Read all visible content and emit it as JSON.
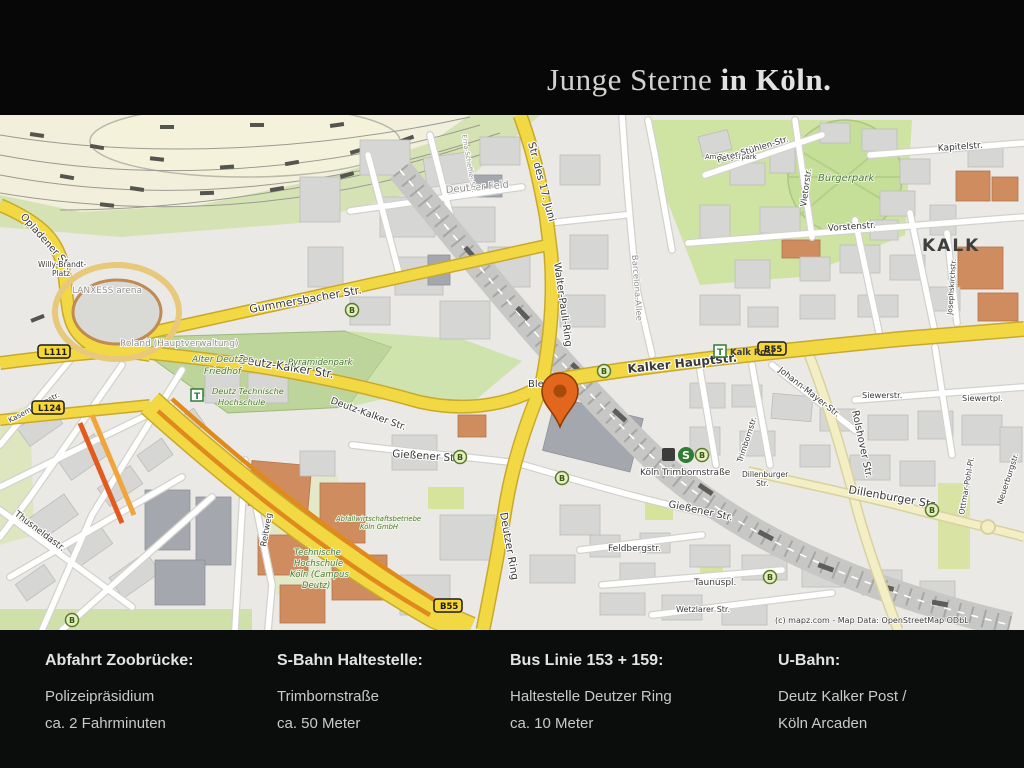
{
  "header": {
    "title_regular": "Junge Sterne",
    "title_bold": "in Köln."
  },
  "footer": {
    "columns": [
      {
        "heading": "Abfahrt Zoobrücke:",
        "line1": "Polizeipräsidium",
        "line2": "ca. 2 Fahrminuten"
      },
      {
        "heading": "S-Bahn Haltestelle:",
        "line1": "Trimbornstraße",
        "line2": "ca. 50 Meter"
      },
      {
        "heading": "Bus Linie 153 + 159:",
        "line1": "Haltestelle Deutzer Ring",
        "line2": "ca. 10 Meter"
      },
      {
        "heading": "U-Bahn:",
        "line1": "Deutz Kalker Post /",
        "line2": "Köln Arcaden"
      }
    ]
  },
  "map": {
    "attribution": "(c) mapz.com - Map Data: OpenStreetMap ODbL",
    "city": "KALK",
    "badges": {
      "l111": "L111",
      "l124": "L124",
      "b55": "B55",
      "bus": "B",
      "sbahn": "S",
      "tram": "T",
      "kalk_post": "Kalk Post"
    },
    "streets": {
      "opladener": "Opladener Str.",
      "willy1": "Willy-Brandt-",
      "willy2": "Platz",
      "arena": "LANXESS arena",
      "gummersbacher": "Gummersbacher Str.",
      "deutz_kalker": "Deutz-Kalker Str.",
      "str17juni": "Str. des 17. Juni",
      "walter_pauli": "Walter-Pauli-Ring",
      "barcelona": "Barcelona-Allee",
      "deutzer_feld": "Deutzer Feld",
      "erna": "Erna-Scheffler-Str.",
      "buergerpark": "Bürgerpark",
      "am_buergerpark": "Am Bürgerpark",
      "peter_stuehlen": "Peter-Stühlen-Str.",
      "vietorstr": "Vietorstr.",
      "kapitelstr": "Kapitelstr.",
      "vorstenstr": "Vorstenstr.",
      "josephskirchstr": "Josephskirchstr.",
      "kalker_hauptstr": "Kalker Hauptstr.",
      "johann_mayer": "Johann-Mayer-Str.",
      "trimbornstr": "Trimbornstr.",
      "rolshover": "Rolshover Str.",
      "siewerstr": "Siewerstr.",
      "siewertpl": "Siewertpl.",
      "dillenburger": "Dillenburger Str.",
      "dillenburger_s1": "Dillenburger",
      "dillenburger_s2": "Str.",
      "ottmar": "Ottmar-Pohl-Pl.",
      "neuerburgstr": "Neuerburgstr.",
      "giessener": "Gießener Str.",
      "deutzer_ring": "Deutzer Ring",
      "bleses": "Bleses",
      "koeln_trimbornstrasse": "Köln Trimbornstraße",
      "feldbergstr": "Feldbergstr.",
      "taunuspl": "Taunuspl.",
      "wetzlarer": "Wetzlarer Str.",
      "thusneldastr": "Thusneldastr.",
      "reitweg": "Reitweg",
      "kasematten": "Kasemattenstr.",
      "roland": "Roland (Hauptverwaltung)"
    },
    "areas": {
      "friedhof1": "Alter Deutzer",
      "friedhof2": "Friedhof",
      "pyramidenpark": "Pyramidenpark",
      "dth1": "Deutz Technische",
      "dth2": "Hochschule",
      "th1": "Technische",
      "th2": "Hochschule",
      "th3": "Köln (Campus",
      "th4": "Deutz)",
      "abfall1": "Abfallwirtschaftsbetriebe",
      "abfall2": "Köln GmbH"
    },
    "colors": {
      "road_major": "#f2d943",
      "road_pale": "#f3eec4",
      "park": "#cfe3a2",
      "cemetery": "#bdd49a",
      "building": "#d6d6d4",
      "building_accent": "#cf8c5f",
      "marker": "#e2661c",
      "badge_yellow": "#f7d735",
      "transit_green": "#2e7d32",
      "title_silver": "#d2d2d0"
    }
  }
}
